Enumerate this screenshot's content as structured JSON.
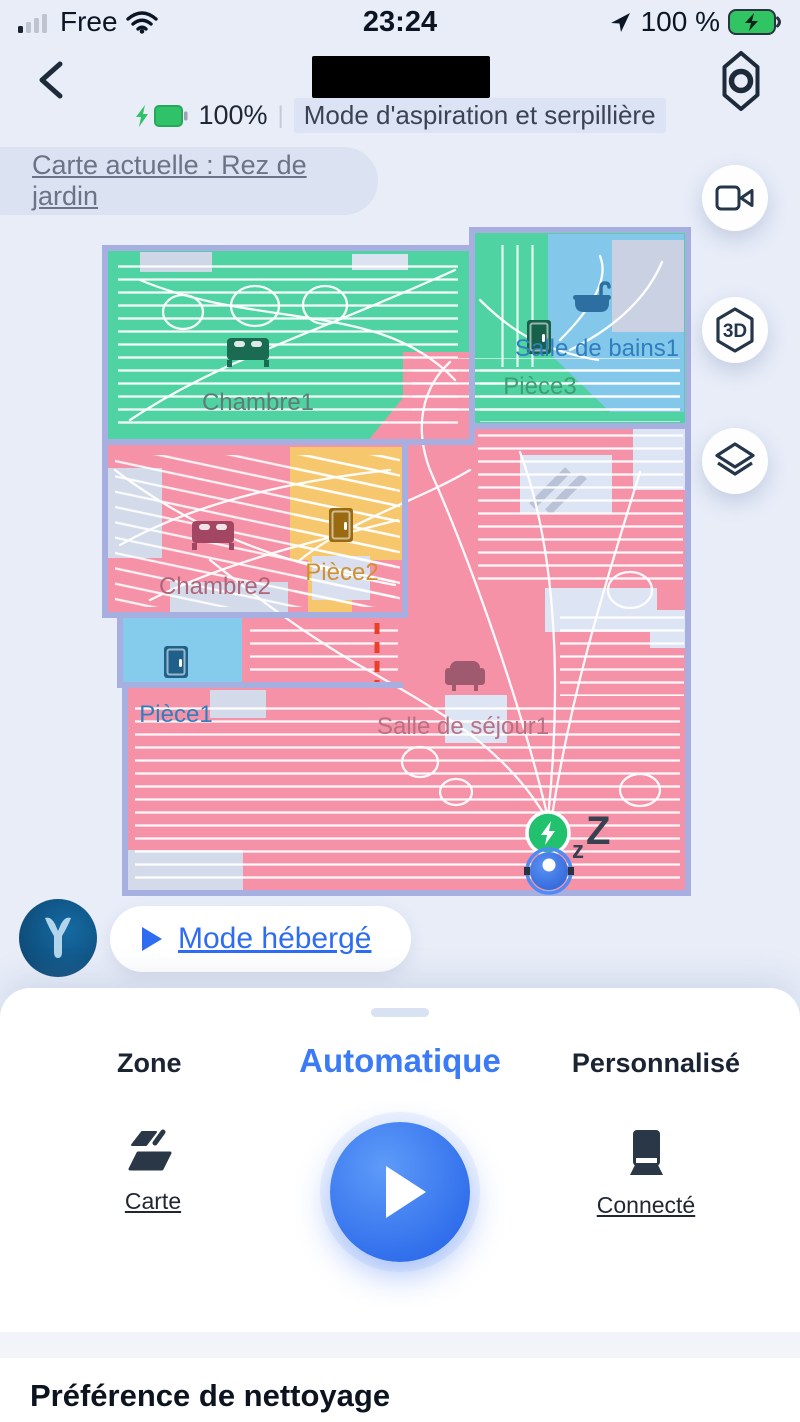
{
  "status_bar": {
    "carrier": "Free",
    "time": "23:24",
    "battery_percent": "100 %"
  },
  "device_status": {
    "battery": "100%",
    "separator": "|",
    "mode": "Mode d'aspiration et serpillière"
  },
  "map_banner": {
    "label": "Carte actuelle : Rez de jardin"
  },
  "map": {
    "rooms": [
      {
        "name": "Chambre1",
        "color": "#4fd3a2",
        "icon": "bed"
      },
      {
        "name": "Chambre2",
        "color": "#f592a8",
        "icon": "bed"
      },
      {
        "name": "Pièce1",
        "color": "#85cbec",
        "icon": "door"
      },
      {
        "name": "Pièce2",
        "color": "#f6c76c",
        "icon": "door"
      },
      {
        "name": "Pièce3",
        "color": "#4fd3a2",
        "icon": "door"
      },
      {
        "name": "Salle de bains1",
        "color": "#83c7eb",
        "icon": "bathtub"
      },
      {
        "name": "Salle de séjour1",
        "color": "#f592a8",
        "icon": "couch"
      }
    ],
    "sleep_small": "z",
    "sleep_big": "Z"
  },
  "side_controls": {
    "three_d_label": "3D"
  },
  "hosted_mode": {
    "label": "Mode hébergé"
  },
  "control_sheet": {
    "tabs": [
      {
        "label": "Zone"
      },
      {
        "label": "Automatique"
      },
      {
        "label": "Personnalisé"
      }
    ],
    "map_button": "Carte",
    "dock_button": "Connecté"
  },
  "section_title": "Préférence de nettoyage",
  "colors": {
    "accent": "#3b7bf5",
    "battery_green": "#31c463",
    "wall": "#a6afe0",
    "virtual_wall": "#e8402a",
    "background": "#e8edf8"
  }
}
